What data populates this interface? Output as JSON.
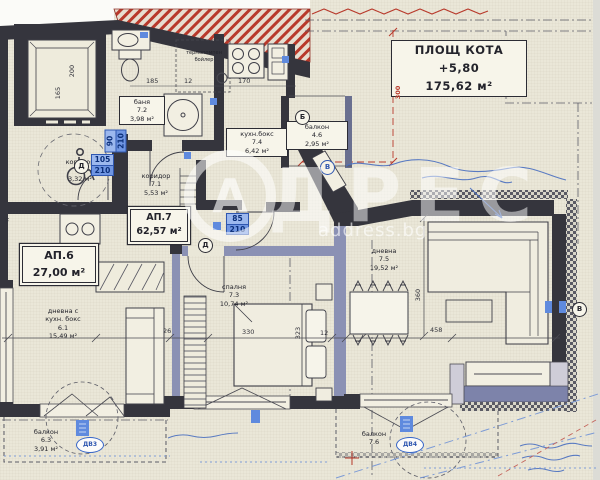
{
  "title_box": {
    "line1": "ПЛОЩ КОТА +5,80",
    "line2": "175,62 м²"
  },
  "watermark": {
    "logo_letter": "А",
    "brand": "ДРЕС",
    "domain": "address.bg"
  },
  "apartments": {
    "ap7": {
      "name": "АП.7",
      "area": "62,57 м²"
    },
    "ap6": {
      "name": "АП.6",
      "area": "27,00 м²"
    }
  },
  "rooms": {
    "bath": {
      "name": "баня",
      "num": "7.2",
      "area": "3,98 м²"
    },
    "kitchen": {
      "name": "кухн.бокс",
      "num": "7.4",
      "area": "6,42 м²"
    },
    "balcony46": {
      "name": "балкон",
      "num": "4.6",
      "area": "2,95 м²"
    },
    "corridor71": {
      "name": "коридор",
      "num": "7.1",
      "area": "5,53 м²"
    },
    "corridor02": {
      "name": "коридор",
      "num": "0.2",
      "area": "3,32 м²"
    },
    "bedroom": {
      "name": "спалня",
      "num": "7.3",
      "area": "10,74 м²"
    },
    "living75": {
      "name": "дневна",
      "num": "7.5",
      "area": "19,52 м²"
    },
    "living61": {
      "line1": "дневна с",
      "line2": "кухн. бокс",
      "num": "6.1",
      "area": "15,49 м²"
    },
    "balcony63": {
      "name": "балкон",
      "num": "6.3",
      "area": "3,91 м²"
    },
    "balcony76": {
      "name": "балкон",
      "num": "7.6"
    }
  },
  "equipment": {
    "boiler_line1": "термопомпен",
    "boiler_line2": "бойлер"
  },
  "dimensions": {
    "elevator_depth": "200",
    "elevator_width": "165",
    "top_a": "185",
    "top_b": "12",
    "top_c": "170",
    "red_offset": "300",
    "bedroom_width": "330",
    "bedroom_height": "323",
    "bedroom_gap": "12",
    "wall_t": "26",
    "living_width": "458",
    "living_height": "360"
  },
  "door_tags": {
    "entry_main": {
      "w": "105",
      "h": "210"
    },
    "ap7_entry": {
      "w": "85",
      "h": "210"
    },
    "bath_door": {
      "w": "90",
      "h": "210"
    }
  },
  "marks": {
    "door_a": "Д",
    "door_b": "Д",
    "balcony_b": "Б",
    "note_b": "В",
    "window_r": "В",
    "oval_left": "ДВ3",
    "oval_right": "ДВ4",
    "f_label": "F"
  },
  "colors": {
    "paper": "#eae7d8",
    "wall": "#35353d",
    "wall_accent": "#7d83aa",
    "roof_red": "#b8392b",
    "tag_blue": "#5f8ade",
    "annotation_blue": "#4a6fc0"
  }
}
